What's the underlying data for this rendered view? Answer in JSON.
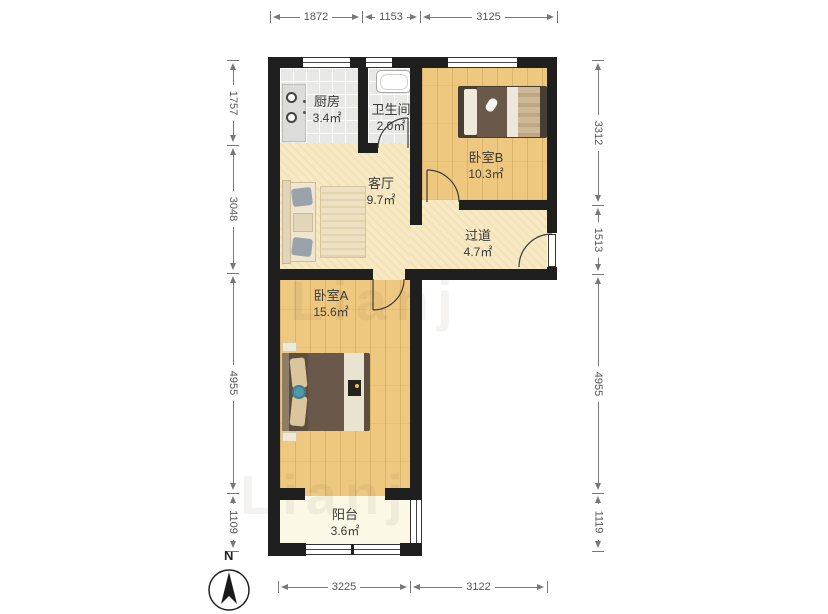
{
  "floorplan": {
    "rooms": [
      {
        "name": "厨房",
        "area": "3.4㎡"
      },
      {
        "name": "卫生间",
        "area": "2.0㎡"
      },
      {
        "name": "客厅",
        "area": "9.7㎡"
      },
      {
        "name": "卧室B",
        "area": "10.3㎡"
      },
      {
        "name": "过道",
        "area": "4.7㎡"
      },
      {
        "name": "卧室A",
        "area": "15.6㎡"
      },
      {
        "name": "阳台",
        "area": "3.6㎡"
      }
    ],
    "dimensions_mm": {
      "top": [
        "1872",
        "1153",
        "3125"
      ],
      "left": [
        "1757",
        "3048",
        "4955",
        "1109"
      ],
      "right": [
        "3312",
        "1513",
        "4955",
        "1119"
      ],
      "bottom": [
        "3225",
        "3122"
      ]
    },
    "compass": {
      "label": "N"
    },
    "watermark": "Lianj",
    "colors": {
      "wall": "#1f1f1f",
      "wood_floor": "#eec87f",
      "living_floor": "#f7e9c3",
      "tile_floor": "#e8e8e6",
      "balcony_floor": "#fbf8e6",
      "dimension_text": "#555555"
    }
  }
}
